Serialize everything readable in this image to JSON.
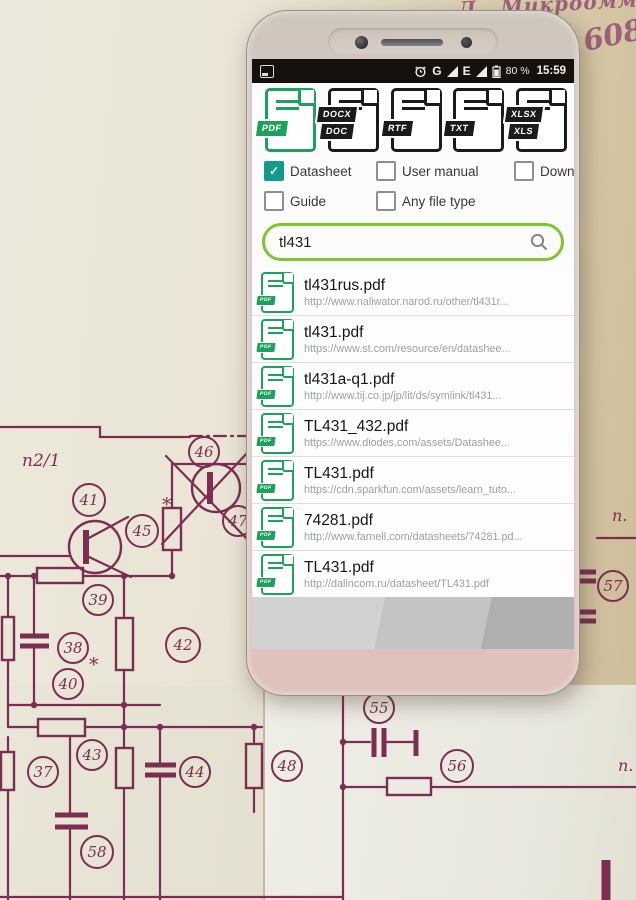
{
  "scene": {
    "handwriting": {
      "letter": "Д",
      "word": "Микроомметр",
      "number": "608"
    },
    "paper_ink": "#7c2d52"
  },
  "schematic": {
    "labels": [
      {
        "text": "п2/1",
        "x": 22,
        "y": 466,
        "size": 17
      },
      {
        "text": "п.",
        "x": 612,
        "y": 521,
        "size": 16
      },
      {
        "text": "п.",
        "x": 618,
        "y": 771,
        "size": 16
      }
    ],
    "callouts": [
      {
        "n": "46",
        "x": 204,
        "y": 452,
        "r": 15
      },
      {
        "n": "47",
        "x": 238,
        "y": 521,
        "r": 15
      },
      {
        "n": "41",
        "x": 89,
        "y": 500,
        "r": 16
      },
      {
        "n": "45",
        "x": 142,
        "y": 531,
        "r": 16,
        "star": [
          162,
          511
        ]
      },
      {
        "n": "39",
        "x": 98,
        "y": 600,
        "r": 15
      },
      {
        "n": "38",
        "x": 73,
        "y": 648,
        "r": 15
      },
      {
        "n": "40",
        "x": 68,
        "y": 684,
        "r": 15,
        "star": [
          89,
          671
        ]
      },
      {
        "n": "42",
        "x": 183,
        "y": 645,
        "r": 17
      },
      {
        "n": "43",
        "x": 92,
        "y": 755,
        "r": 15
      },
      {
        "n": "37",
        "x": 43,
        "y": 772,
        "r": 15
      },
      {
        "n": "44",
        "x": 195,
        "y": 772,
        "r": 15
      },
      {
        "n": "48",
        "x": 287,
        "y": 766,
        "r": 15
      },
      {
        "n": "58",
        "x": 97,
        "y": 852,
        "r": 16
      },
      {
        "n": "55",
        "x": 379,
        "y": 708,
        "r": 15
      },
      {
        "n": "56",
        "x": 457,
        "y": 766,
        "r": 16
      },
      {
        "n": "57",
        "x": 613,
        "y": 586,
        "r": 15
      }
    ]
  },
  "phone": {
    "colors": {
      "accent_green": "#1ba35b",
      "icon_black": "#1b1b1b",
      "search_border": "#7cc62f",
      "checkbox_teal": "#0f9d8a"
    },
    "status_bar": {
      "time": "15:59",
      "battery_percent": "80 %",
      "net_g": "G",
      "net_e": "E"
    },
    "file_types": [
      {
        "name": "pdf",
        "banners": [
          "PDF"
        ],
        "selected": true
      },
      {
        "name": "doc",
        "banners": [
          "DOCX",
          "DOC"
        ],
        "selected": false
      },
      {
        "name": "rtf",
        "banners": [
          "RTF"
        ],
        "selected": false
      },
      {
        "name": "txt",
        "banners": [
          "TXT"
        ],
        "selected": false
      },
      {
        "name": "xls",
        "banners": [
          "XLSX",
          "XLS"
        ],
        "selected": false
      }
    ],
    "filters": [
      {
        "label": "Datasheet",
        "checked": true
      },
      {
        "label": "User manual",
        "checked": false
      },
      {
        "label": "Download",
        "checked": false
      },
      {
        "label": "Guide",
        "checked": false
      },
      {
        "label": "Any file type",
        "checked": false
      }
    ],
    "search": {
      "value": "tl431"
    },
    "results": [
      {
        "title": "tl431rus.pdf",
        "url": "http://www.naliwator.narod.ru/other/tl431r..."
      },
      {
        "title": "tl431.pdf",
        "url": "https://www.st.com/resource/en/datashee..."
      },
      {
        "title": "tl431a-q1.pdf",
        "url": "http://www.tij.co.jp/jp/lit/ds/symlink/tl431..."
      },
      {
        "title": "TL431_432.pdf",
        "url": "https://www.diodes.com/assets/Datashee..."
      },
      {
        "title": "TL431.pdf",
        "url": "https://cdn.sparkfun.com/assets/learn_tuto..."
      },
      {
        "title": "74281.pdf",
        "url": "http://www.farnell.com/datasheets/74281.pd..."
      },
      {
        "title": "TL431.pdf",
        "url": "http://dalincom.ru/datasheet/TL431.pdf"
      }
    ]
  }
}
